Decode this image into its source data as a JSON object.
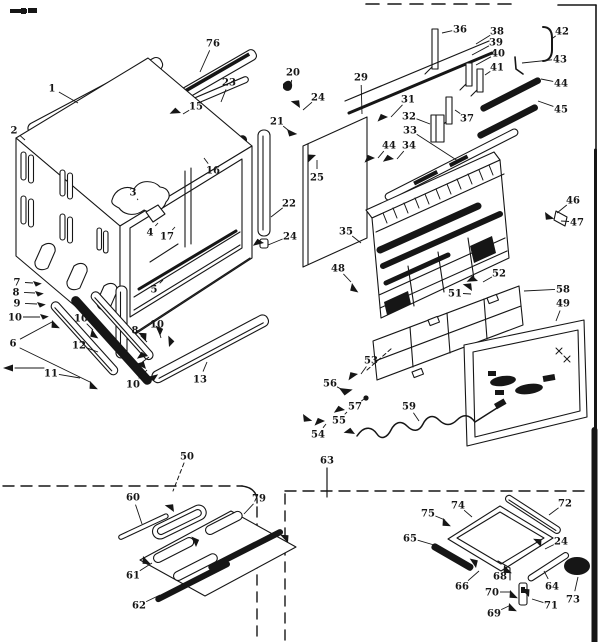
{
  "figure": {
    "kind": "exploded-parts-diagram",
    "colors": {
      "ink": "#161616",
      "paper": "#ffffff"
    }
  },
  "callouts": [
    {
      "n": "1",
      "x": 52,
      "y": 88,
      "tx": 78,
      "ty": 103
    },
    {
      "n": "2",
      "x": 14,
      "y": 130,
      "tx": 25,
      "ty": 140
    },
    {
      "n": "76",
      "x": 213,
      "y": 43,
      "tx": 200,
      "ty": 72
    },
    {
      "n": "15",
      "x": 196,
      "y": 106,
      "tx": 183,
      "ty": 114
    },
    {
      "n": "23",
      "x": 229,
      "y": 82,
      "tx": 221,
      "ty": 102
    },
    {
      "n": "20",
      "x": 293,
      "y": 72,
      "tx": 290,
      "ty": 90
    },
    {
      "n": "24",
      "x": 318,
      "y": 97,
      "tx": 303,
      "ty": 110
    },
    {
      "n": "21",
      "x": 277,
      "y": 121,
      "tx": 288,
      "ty": 130
    },
    {
      "n": "16",
      "x": 213,
      "y": 170,
      "tx": 204,
      "ty": 158
    },
    {
      "n": "3",
      "x": 133,
      "y": 192,
      "tx": 138,
      "ty": 200
    },
    {
      "n": "25",
      "x": 317,
      "y": 177,
      "tx": 317,
      "ty": 160
    },
    {
      "n": "22",
      "x": 289,
      "y": 203,
      "tx": 271,
      "ty": 217
    },
    {
      "n": "24",
      "x": 290,
      "y": 236,
      "tx": 268,
      "ty": 245
    },
    {
      "n": "29",
      "x": 361,
      "y": 77,
      "tx": 362,
      "ty": 114
    },
    {
      "n": "35",
      "x": 346,
      "y": 231,
      "tx": 361,
      "ty": 243
    },
    {
      "n": "48",
      "x": 338,
      "y": 268,
      "tx": 351,
      "ty": 282
    },
    {
      "n": "4",
      "x": 150,
      "y": 232,
      "tx": 158,
      "ty": 223
    },
    {
      "n": "17",
      "x": 167,
      "y": 236,
      "tx": 175,
      "ty": 227
    },
    {
      "n": "5",
      "x": 154,
      "y": 289,
      "tx": 163,
      "ty": 280
    },
    {
      "n": "7",
      "x": 17,
      "y": 282,
      "tx": 33,
      "ty": 283
    },
    {
      "n": "8",
      "x": 16,
      "y": 292,
      "tx": 35,
      "ty": 293
    },
    {
      "n": "9",
      "x": 17,
      "y": 303,
      "tx": 37,
      "ty": 304
    },
    {
      "n": "10",
      "x": 15,
      "y": 317,
      "tx": 40,
      "ty": 317
    },
    {
      "n": "6",
      "x": 13,
      "y": 343,
      "tx": 52,
      "ty": 322
    },
    {
      "n": "10",
      "x": 81,
      "y": 318,
      "tx": 93,
      "ty": 330
    },
    {
      "n": "12",
      "x": 79,
      "y": 345,
      "tx": 98,
      "ty": 352
    },
    {
      "n": "11",
      "x": 51,
      "y": 373,
      "tx": 80,
      "ty": 378
    },
    {
      "n": "8",
      "x": 135,
      "y": 330,
      "tx": 147,
      "ty": 342
    },
    {
      "n": "10",
      "x": 157,
      "y": 324,
      "tx": 161,
      "ty": 338
    },
    {
      "n": "9",
      "x": 136,
      "y": 367,
      "tx": 149,
      "ty": 357
    },
    {
      "n": "10",
      "x": 133,
      "y": 384,
      "tx": 147,
      "ty": 370
    },
    {
      "n": "13",
      "x": 200,
      "y": 379,
      "tx": 207,
      "ty": 362
    },
    {
      "n": "36",
      "x": 460,
      "y": 29,
      "tx": 442,
      "ty": 33
    },
    {
      "n": "38",
      "x": 497,
      "y": 31,
      "tx": 476,
      "ty": 44
    },
    {
      "n": "39",
      "x": 496,
      "y": 42,
      "tx": 472,
      "ty": 55
    },
    {
      "n": "40",
      "x": 498,
      "y": 53,
      "tx": 476,
      "ty": 65
    },
    {
      "n": "41",
      "x": 497,
      "y": 67,
      "tx": 485,
      "ty": 75
    },
    {
      "n": "42",
      "x": 562,
      "y": 31,
      "tx": 553,
      "ty": 38
    },
    {
      "n": "43",
      "x": 560,
      "y": 59,
      "tx": 522,
      "ty": 63
    },
    {
      "n": "44",
      "x": 561,
      "y": 83,
      "tx": 541,
      "ty": 79
    },
    {
      "n": "45",
      "x": 561,
      "y": 109,
      "tx": 538,
      "ty": 101
    },
    {
      "n": "37",
      "x": 467,
      "y": 118,
      "tx": 455,
      "ty": 110
    },
    {
      "n": "31",
      "x": 408,
      "y": 99,
      "tx": 391,
      "ty": 117
    },
    {
      "n": "32",
      "x": 409,
      "y": 116,
      "tx": 430,
      "ty": 124
    },
    {
      "n": "33",
      "x": 410,
      "y": 130,
      "tx": 458,
      "ty": 161
    },
    {
      "n": "44",
      "x": 389,
      "y": 145,
      "tx": 378,
      "ty": 158
    },
    {
      "n": "34",
      "x": 409,
      "y": 145,
      "tx": 397,
      "ty": 159
    },
    {
      "n": "46",
      "x": 573,
      "y": 200,
      "tx": 557,
      "ty": 213
    },
    {
      "n": "47",
      "x": 577,
      "y": 222,
      "tx": 561,
      "ty": 221
    },
    {
      "n": "52",
      "x": 499,
      "y": 273,
      "tx": 483,
      "ty": 282
    },
    {
      "n": "51",
      "x": 455,
      "y": 293,
      "tx": 471,
      "ty": 294
    },
    {
      "n": "58",
      "x": 563,
      "y": 289,
      "tx": 524,
      "ty": 291
    },
    {
      "n": "49",
      "x": 563,
      "y": 303,
      "tx": 556,
      "ty": 321
    },
    {
      "n": "53",
      "x": 371,
      "y": 360,
      "tx": 361,
      "ty": 374
    },
    {
      "n": "56",
      "x": 330,
      "y": 383,
      "tx": 341,
      "ty": 389
    },
    {
      "n": "57",
      "x": 355,
      "y": 406,
      "tx": 364,
      "ty": 399
    },
    {
      "n": "55",
      "x": 339,
      "y": 420,
      "tx": 347,
      "ty": 412
    },
    {
      "n": "54",
      "x": 318,
      "y": 434,
      "tx": 326,
      "ty": 424
    },
    {
      "n": "59",
      "x": 409,
      "y": 406,
      "tx": 419,
      "ty": 421
    },
    {
      "n": "63",
      "x": 327,
      "y": 460,
      "tx": null,
      "ty": null
    },
    {
      "n": "50",
      "x": 187,
      "y": 456,
      "tx": null,
      "ty": null
    },
    {
      "n": "60",
      "x": 133,
      "y": 497,
      "tx": 142,
      "ty": 524
    },
    {
      "n": "79",
      "x": 259,
      "y": 498,
      "tx": 244,
      "ty": 514
    },
    {
      "n": "61",
      "x": 133,
      "y": 575,
      "tx": 152,
      "ty": 563
    },
    {
      "n": "62",
      "x": 139,
      "y": 605,
      "tx": 160,
      "ty": 595
    },
    {
      "n": "75",
      "x": 428,
      "y": 513,
      "tx": 445,
      "ty": 520
    },
    {
      "n": "74",
      "x": 458,
      "y": 505,
      "tx": 472,
      "ty": 517
    },
    {
      "n": "72",
      "x": 565,
      "y": 503,
      "tx": 549,
      "ty": 515
    },
    {
      "n": "65",
      "x": 410,
      "y": 538,
      "tx": 434,
      "ty": 545
    },
    {
      "n": "24",
      "x": 561,
      "y": 541,
      "tx": 545,
      "ty": 549
    },
    {
      "n": "66",
      "x": 462,
      "y": 586,
      "tx": 479,
      "ty": 571
    },
    {
      "n": "68",
      "x": 500,
      "y": 576,
      "tx": 506,
      "ty": 567
    },
    {
      "n": "70",
      "x": 492,
      "y": 592,
      "tx": 511,
      "ty": 592
    },
    {
      "n": "69",
      "x": 494,
      "y": 613,
      "tx": 511,
      "ty": 605
    },
    {
      "n": "71",
      "x": 551,
      "y": 605,
      "tx": 532,
      "ty": 599
    },
    {
      "n": "64",
      "x": 552,
      "y": 586,
      "tx": 544,
      "ty": 571
    },
    {
      "n": "73",
      "x": 573,
      "y": 599,
      "tx": 578,
      "ty": 577
    }
  ]
}
